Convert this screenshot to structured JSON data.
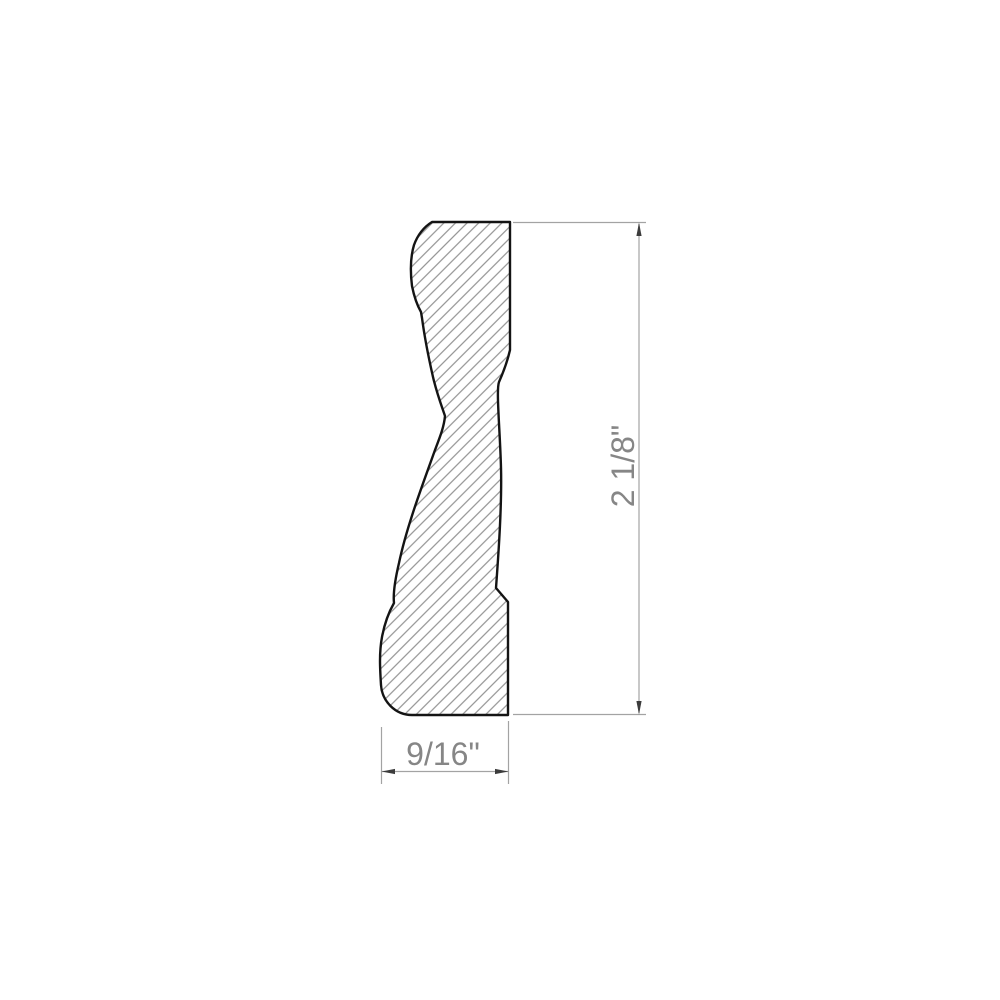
{
  "drawing": {
    "labels": {
      "height": "2 1/8\"",
      "width": "9/16\""
    },
    "colors": {
      "outline": "#141414",
      "hatch": "#8a8a8a",
      "dimension_line": "#a3a3a3",
      "arrow": "#3c3c3c",
      "text": "#868686",
      "background": "#ffffff"
    }
  }
}
